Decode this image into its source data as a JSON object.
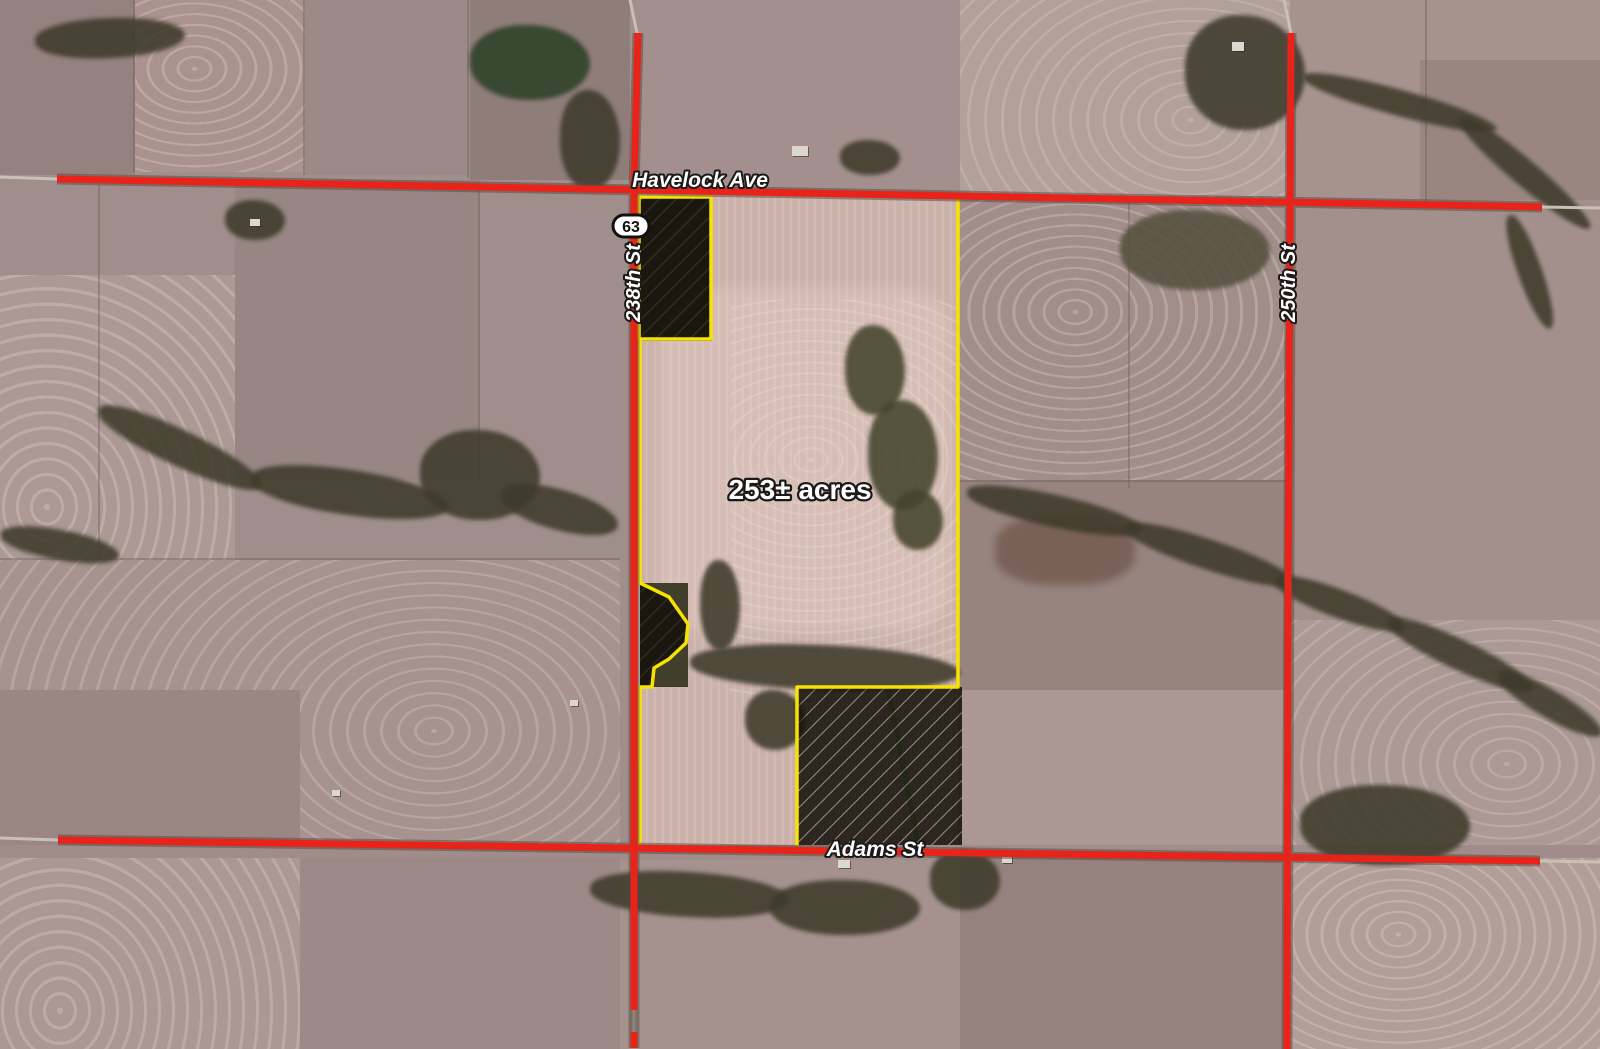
{
  "map": {
    "type": "aerial-parcel-map",
    "acreage_label": "253± acres",
    "roads": {
      "havelock": {
        "label": "Havelock Ave"
      },
      "adams": {
        "label": "Adams St"
      },
      "street_238": {
        "label": "238th St"
      },
      "street_250": {
        "label": "250th St"
      }
    },
    "highway_shield": {
      "number": "63"
    },
    "colors": {
      "road_red": "#e8231a",
      "parcel_boundary_yellow": "#f7e300",
      "hatch_stripe": "#12100b",
      "label_text": "#ffffff",
      "label_outline": "#1c1a18"
    }
  }
}
